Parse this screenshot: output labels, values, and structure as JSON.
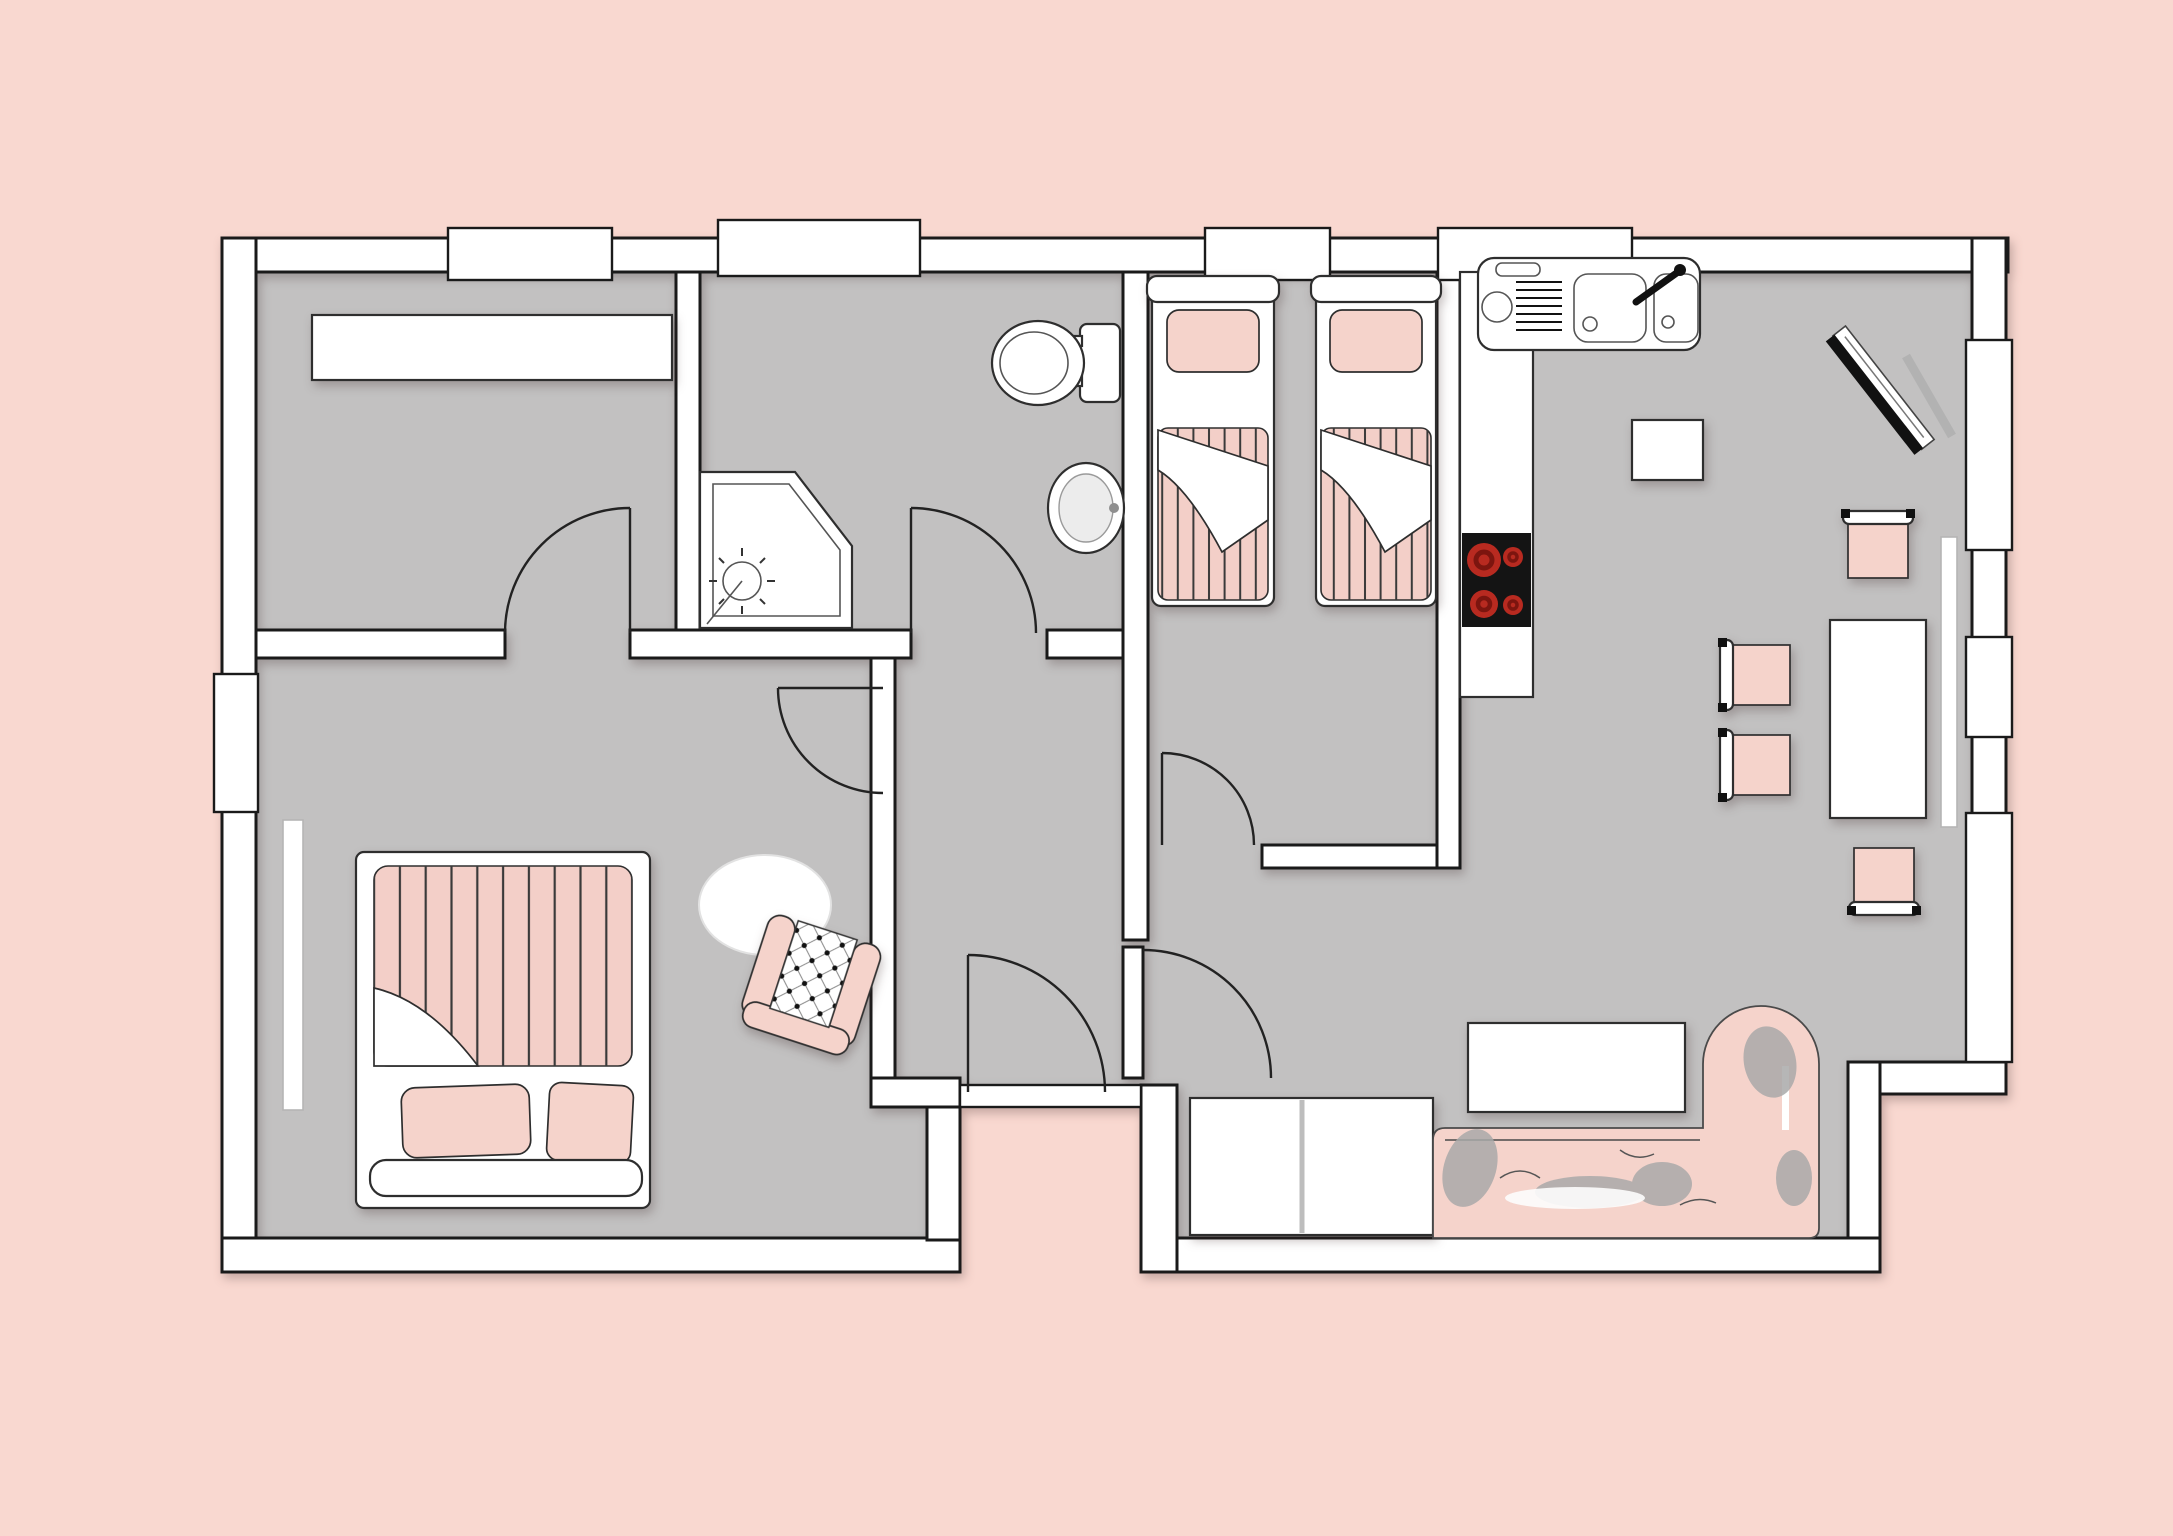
{
  "scene": {
    "type": "apartment floor plan",
    "colors": {
      "background": "#f9d8d0",
      "floor": "#c2c1c1",
      "wall_fill": "#ffffff",
      "wall_outline": "#1a1a1a",
      "furniture_outline": "#2e2e2e",
      "soft_pink": "#f5d3cb",
      "duvet_pink": "#f3cfc8",
      "stripe": "#3a3a3a",
      "stove_body": "#141414",
      "burner_red": "#b82a20",
      "burner_core": "#7c150f",
      "shadow_gray": "#a9a9a9"
    },
    "rooms": [
      {
        "id": "bedroom-top-left",
        "furniture": [
          "wardrobe"
        ]
      },
      {
        "id": "bathroom",
        "furniture": [
          "corner-shower",
          "toilet",
          "wash-basin"
        ]
      },
      {
        "id": "twin-bedroom",
        "furniture": [
          "single-bed-left",
          "single-bed-right"
        ]
      },
      {
        "id": "kitchen",
        "furniture": [
          "counter",
          "double-sink-unit",
          "cooktop",
          "side-table"
        ]
      },
      {
        "id": "dining-area",
        "furniture": [
          "dining-table",
          "chair-top",
          "chair-left-upper",
          "chair-left-lower",
          "chair-bottom"
        ]
      },
      {
        "id": "living-area",
        "furniture": [
          "corner-tv",
          "coffee-table",
          "sectional-sofa",
          "entry-mats"
        ]
      },
      {
        "id": "master-bedroom",
        "furniture": [
          "double-bed",
          "pillow",
          "pillow",
          "oval-rug",
          "armchair"
        ]
      },
      {
        "id": "hallway",
        "furniture": []
      },
      {
        "id": "entrance",
        "furniture": [
          "front-door"
        ]
      }
    ],
    "doors": 6,
    "windows": {
      "top_wall": 4,
      "left_wall": 1,
      "right_wall": 3
    },
    "burners": 4
  }
}
